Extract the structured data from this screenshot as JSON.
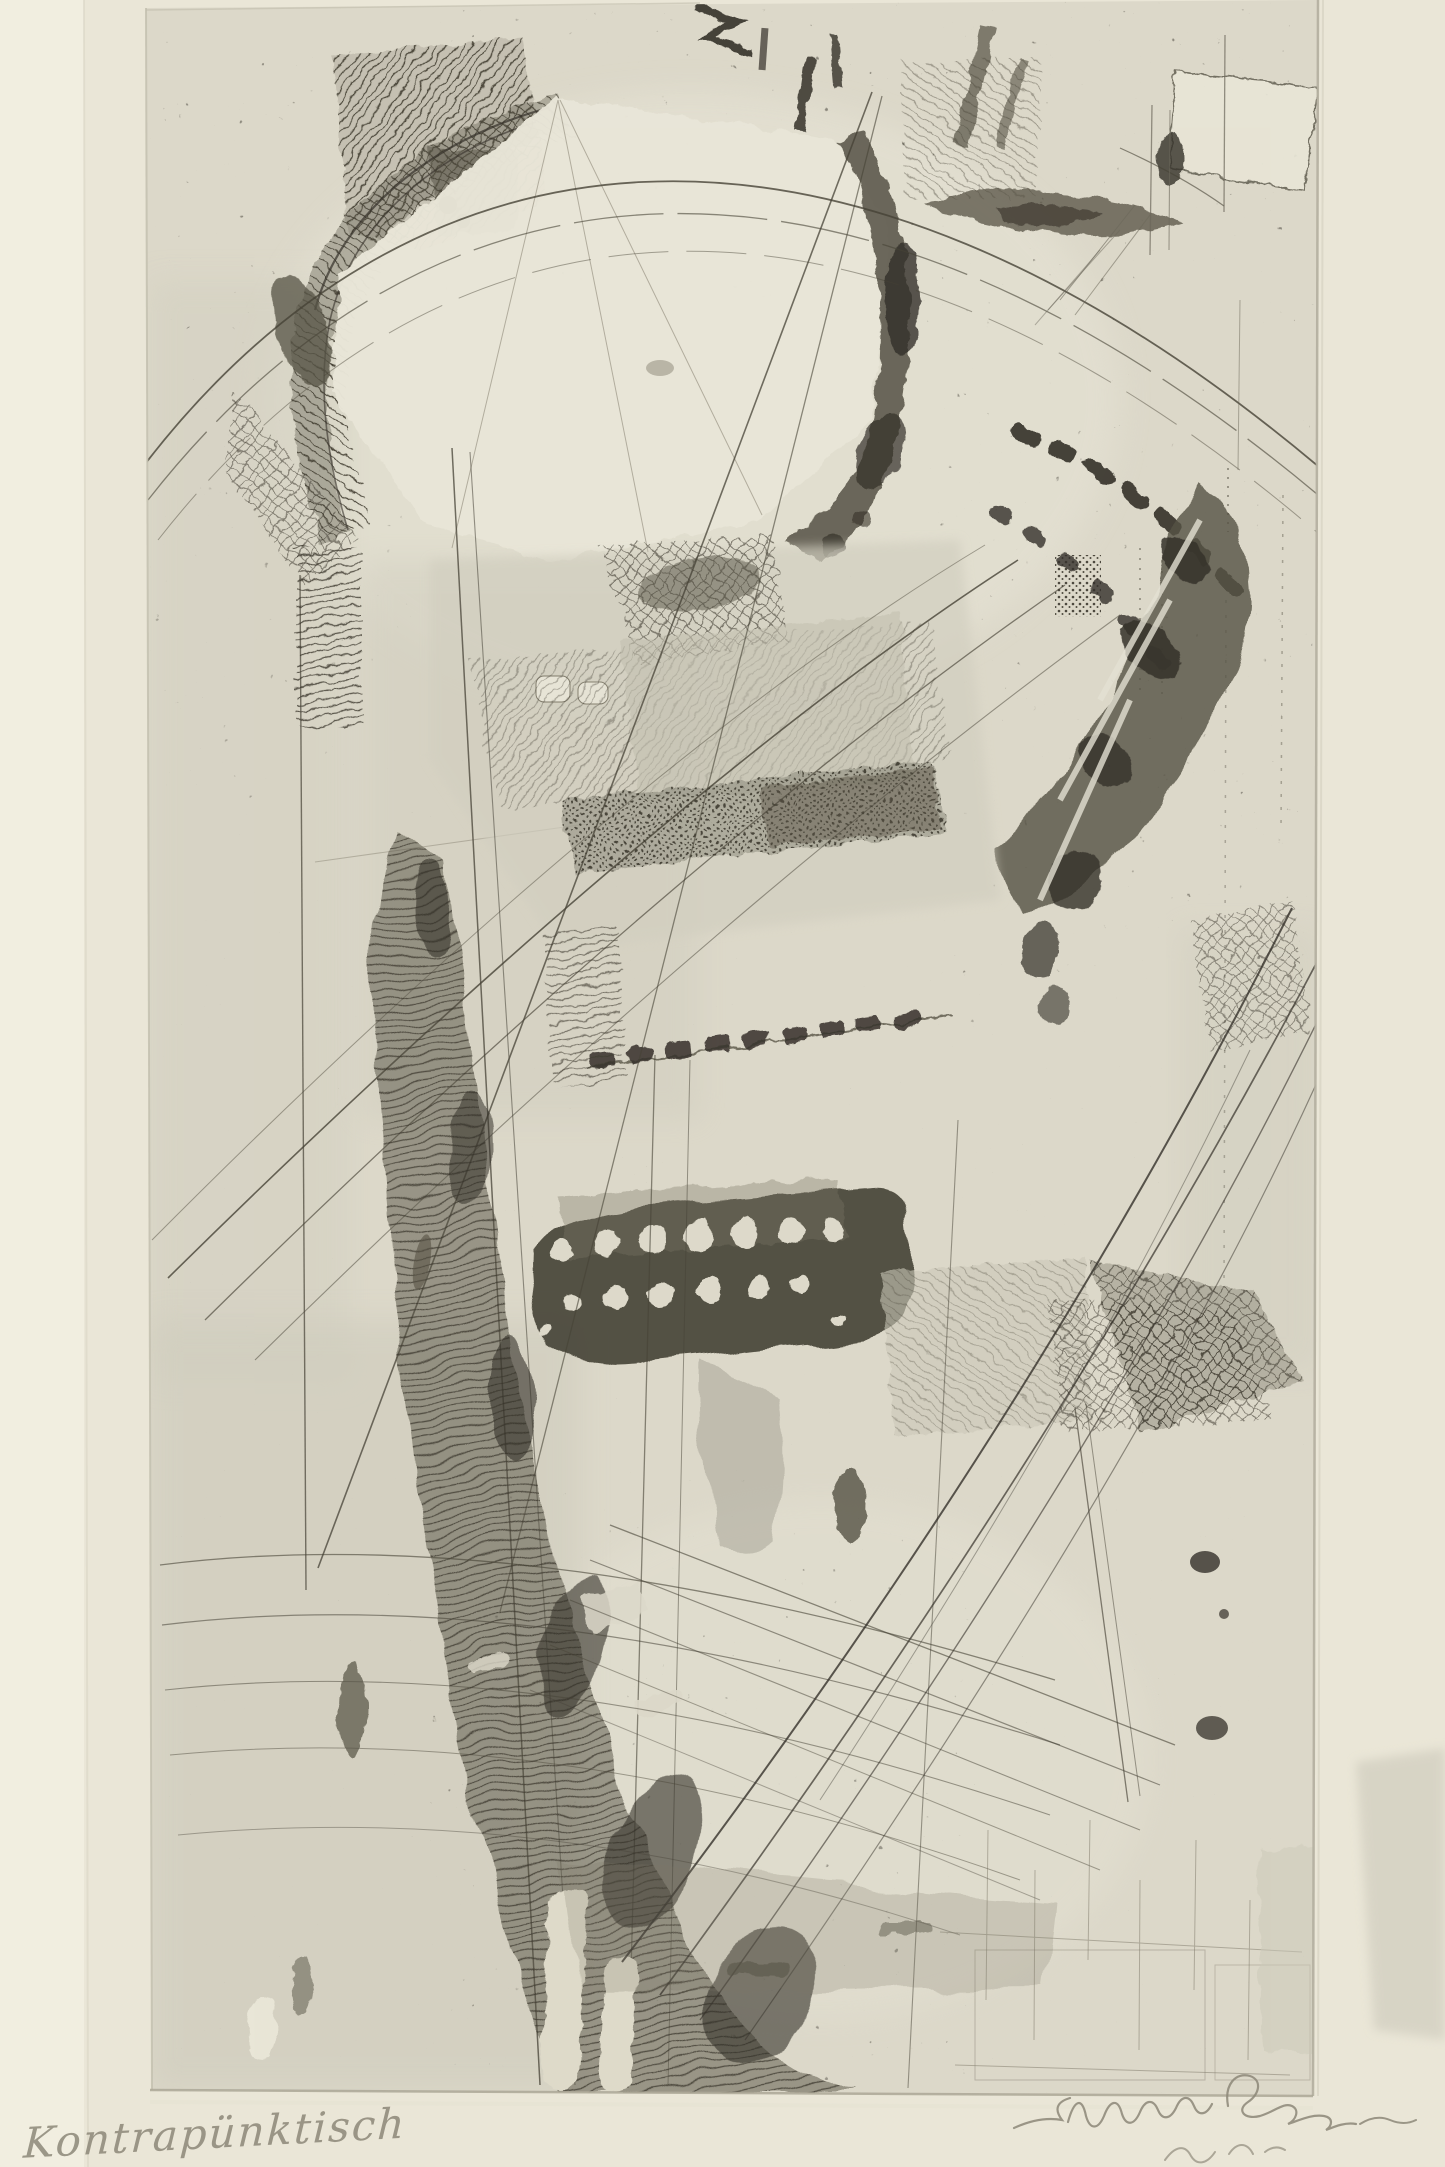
{
  "artwork": {
    "kind": "photograph of an abstract modernist etching / aquatint print on cream wove paper",
    "composition": "abstract counterpoint of sweeping arcs, hatched bands, architectural fragments, a large light polygon upper left, a dark perforated band at center, and a wide dark curving band descending to the lower edge",
    "technique_marks": [
      "plate mark",
      "aquatint washes",
      "drypoint scratches",
      "stipple fields",
      "crosshatching"
    ]
  },
  "inscriptions": {
    "title": "Kontrapünktisch",
    "title_position": "lower left margin, pencil",
    "signature_note": "illegible cursive pencil signature, lower right margin, second line cropped by photo edge"
  },
  "palette": {
    "mat_cream": "#eae6d7",
    "mat_left": "#f1eee0",
    "plate_base": "#dcd8c9",
    "plate_light": "#e7e4d6",
    "wash_light": "#cdcaba",
    "wash_mid": "#b1ae9e",
    "ink_dark": "#35312a",
    "ink_mid": "#56524418",
    "ink_mid_solid": "#565244",
    "ink_faint": "#7d7868",
    "pencil": "#8d8879",
    "plate_edge": "#b2ae9e"
  }
}
